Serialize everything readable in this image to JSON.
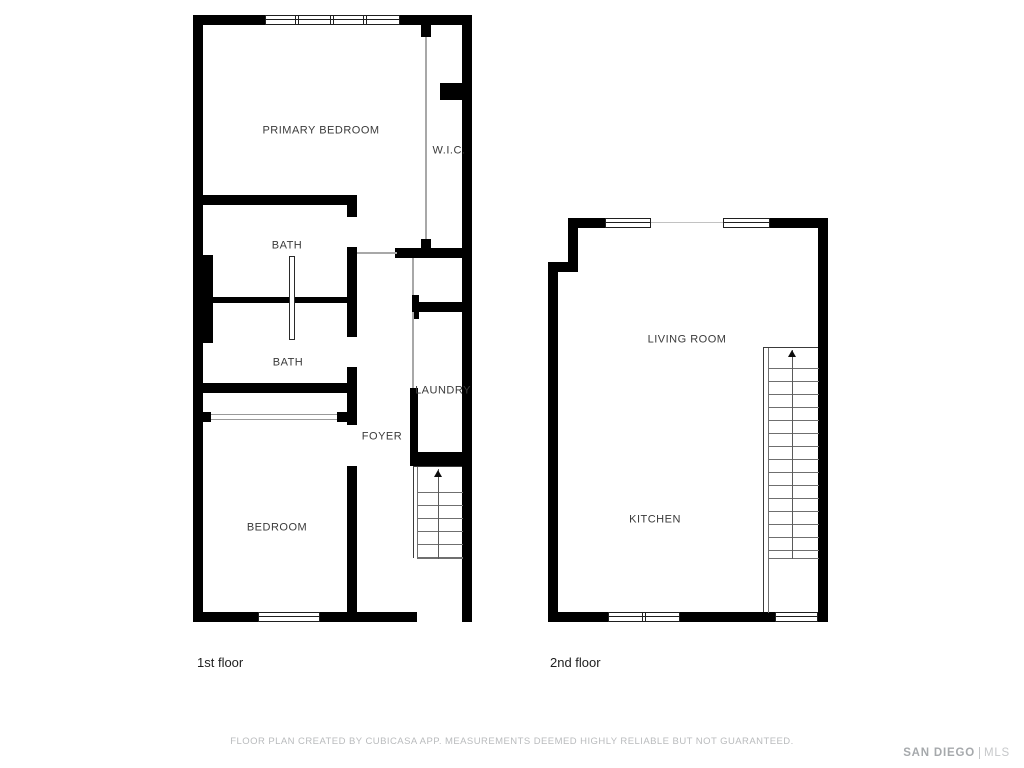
{
  "first_floor": {
    "label": "1st floor",
    "rooms": {
      "primary_bedroom": "PRIMARY BEDROOM",
      "wic": "W.I.C.",
      "bath_upper": "BATH",
      "bath_lower": "BATH",
      "laundry": "LAUNDRY",
      "foyer": "FOYER",
      "bedroom": "BEDROOM"
    }
  },
  "second_floor": {
    "label": "2nd floor",
    "rooms": {
      "living_room": "LIVING ROOM",
      "kitchen": "KITCHEN"
    }
  },
  "footer": {
    "disclaimer": "FLOOR PLAN CREATED BY CUBICASA APP. MEASUREMENTS DEEMED HIGHLY RELIABLE BUT NOT GUARANTEED."
  },
  "branding": {
    "primary": "SAN DIEGO",
    "secondary": "MLS"
  },
  "colors": {
    "wall": "#000000",
    "room_label": "#3a3a3a",
    "floor_label": "#1e1e1e",
    "muted_text": "#b9bbbd",
    "interior_line": "#a8a8a8"
  }
}
